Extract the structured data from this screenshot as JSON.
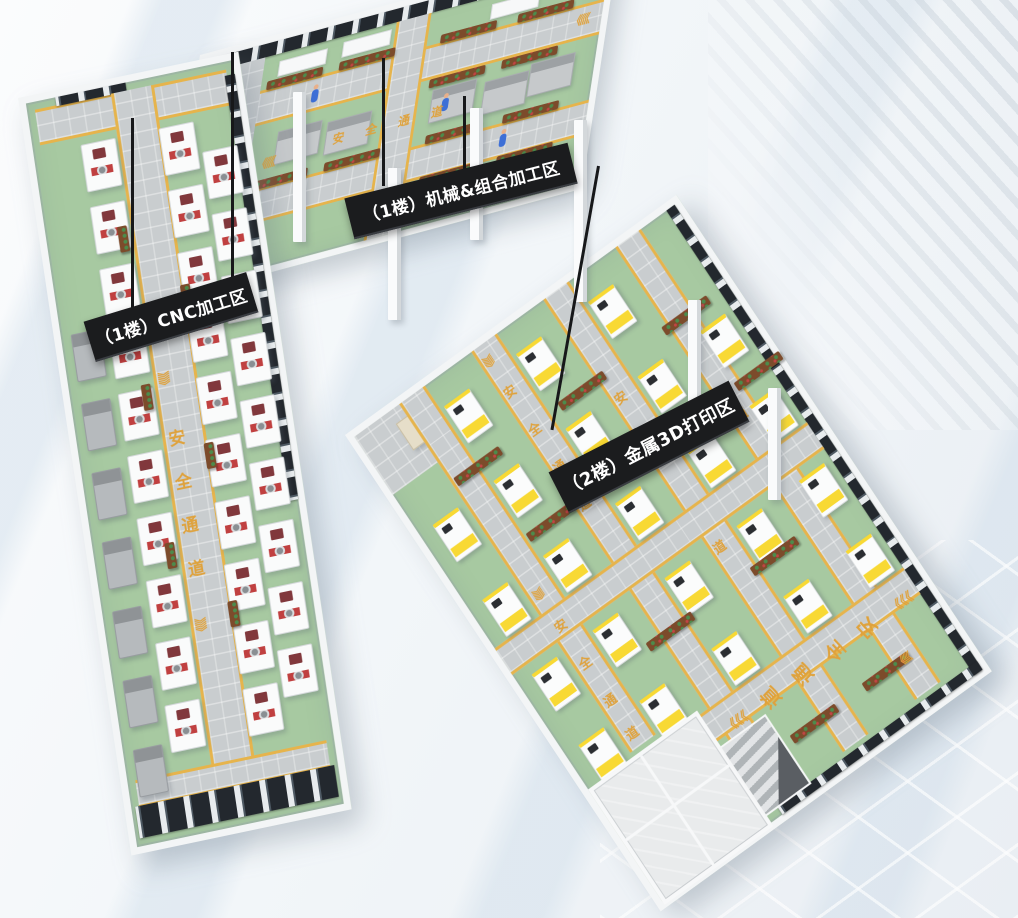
{
  "banners": {
    "cnc_hall": "（1楼）CNC加工区",
    "machining_hall": "（1楼）机械&组合加工区",
    "printing_hall": "（2楼）金属3D打印区"
  },
  "floor_labels": {
    "safe_passage": "安全通道",
    "chars": [
      "安",
      "全",
      "通",
      "道"
    ],
    "chevron": "《",
    "chevron_triple": "《《《"
  },
  "colors": {
    "floor_green": "#A7C9A1",
    "aisle_gray": "#C9CDCF",
    "path_yellow": "#E6B44C",
    "floor_text_orange": "#DFA23C",
    "banner_bg": "#1B1C1E",
    "banner_text": "#FFFFFF",
    "printer_yellow": "#F8D934",
    "cnc_maroon": "#81383C",
    "cnc_red": "#C04040",
    "robot_blue": "#4A63C8",
    "robot_green": "#47A06A",
    "worker_blue": "#3D6FD6",
    "window_dark": "#23262A",
    "wall_white": "#F2F4F5",
    "wood_brown": "#7C4B2B"
  }
}
